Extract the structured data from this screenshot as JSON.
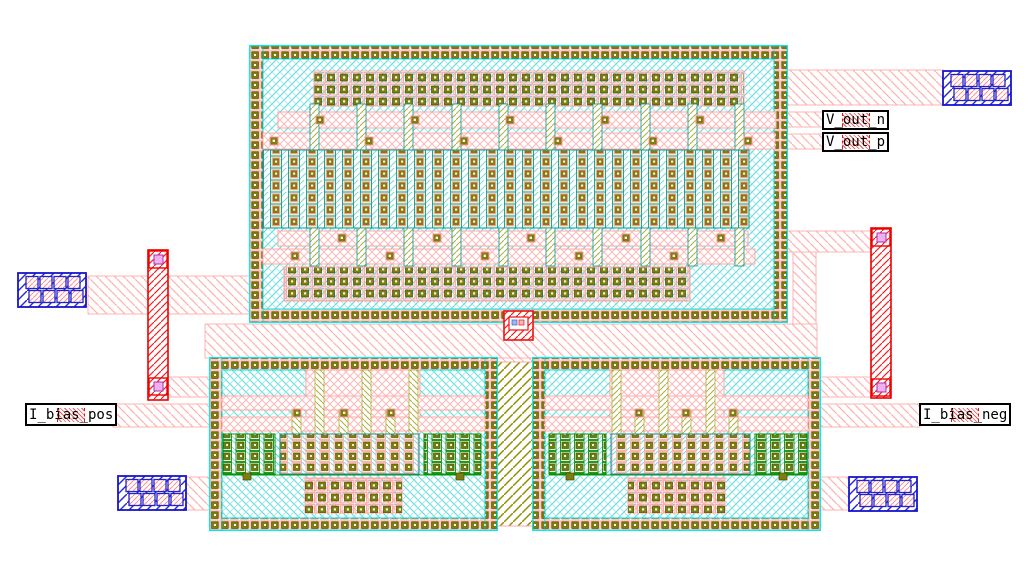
{
  "canvas": {
    "width": 1035,
    "height": 583
  },
  "ports": {
    "v_out_n": {
      "label": "V_out_n"
    },
    "v_out_p": {
      "label": "V_out_p"
    },
    "i_bias_pos": {
      "label": "I_bias_pos"
    },
    "i_bias_neg": {
      "label": "I_bias_neg"
    }
  },
  "palette": {
    "background": "#ffffff",
    "well_border_cyan": "#00ffff",
    "substrate_hatch_cyan": "#5ad8d8",
    "poly_teal": "#0a9a9a",
    "metal_pink": "#ffb0b0",
    "metal2_red": "#ee1111",
    "pad_blue": "#2222cc",
    "diffusion_olive": "#8f8f00",
    "contact_olive_dark": "#4a4a00",
    "device_green": "#089008",
    "via_magenta": "#b040b0",
    "label_text": "#000000"
  }
}
